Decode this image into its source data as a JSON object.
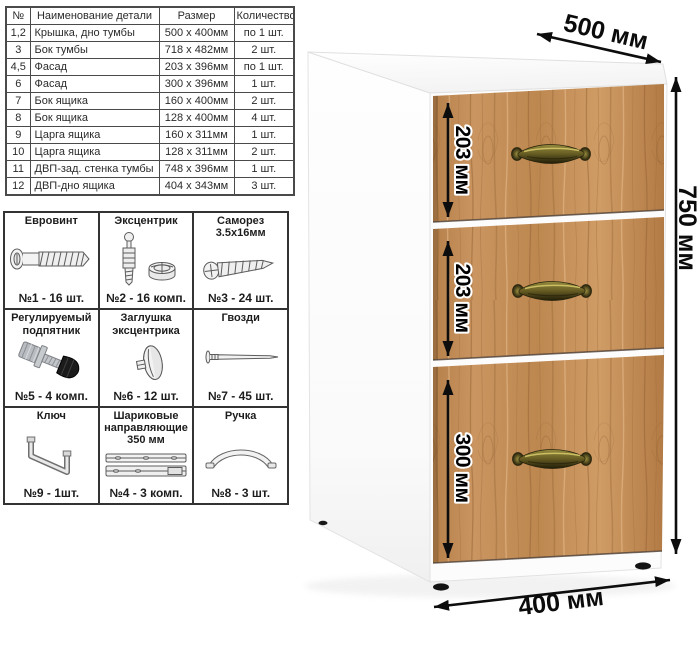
{
  "parts_table": {
    "headers": [
      "№",
      "Наименование детали",
      "Размер",
      "Количество"
    ],
    "rows": [
      {
        "num": "1,2",
        "name": "Крышка, дно тумбы",
        "size": "500 х 400мм",
        "qty": "по 1 шт."
      },
      {
        "num": "3",
        "name": "Бок тумбы",
        "size": "718 х 482мм",
        "qty": "2 шт."
      },
      {
        "num": "4,5",
        "name": "Фасад",
        "size": "203 х 396мм",
        "qty": "по 1 шт."
      },
      {
        "num": "6",
        "name": "Фасад",
        "size": "300 х 396мм",
        "qty": "1 шт."
      },
      {
        "num": "7",
        "name": "Бок ящика",
        "size": "160 х 400мм",
        "qty": "2 шт."
      },
      {
        "num": "8",
        "name": "Бок ящика",
        "size": "128 х 400мм",
        "qty": "4 шт."
      },
      {
        "num": "9",
        "name": "Царга ящика",
        "size": "160 х 311мм",
        "qty": "1 шт."
      },
      {
        "num": "10",
        "name": "Царга ящика",
        "size": "128 х 311мм",
        "qty": "2 шт."
      },
      {
        "num": "11",
        "name": "ДВП-зад. стенка тумбы",
        "size": "748 х 396мм",
        "qty": "1 шт."
      },
      {
        "num": "12",
        "name": "ДВП-дно ящика",
        "size": "404 х 343мм",
        "qty": "3 шт."
      }
    ]
  },
  "hardware": {
    "items": [
      {
        "title": "Евровинт",
        "count": "№1 - 16 шт.",
        "icon": "euro-screw"
      },
      {
        "title": "Эксцентрик",
        "count": "№2 - 16 комп.",
        "icon": "eccentric-cam"
      },
      {
        "title": "Саморез 3.5х16мм",
        "count": "№3 - 24 шт.",
        "icon": "self-tapping-screw"
      },
      {
        "title": "Регулируемый подпятник",
        "count": "№5 - 4 комп.",
        "icon": "adjustable-foot"
      },
      {
        "title": "Заглушка эксцентрика",
        "count": "№6 - 12 шт.",
        "icon": "cam-cap"
      },
      {
        "title": "Гвозди",
        "count": "№7 - 45 шт.",
        "icon": "nail"
      },
      {
        "title": "Ключ",
        "count": "№9 - 1шт.",
        "icon": "hex-key"
      },
      {
        "title": "Шариковые направляющие 350 мм",
        "count": "№4 - 3 комп.",
        "icon": "ball-slides"
      },
      {
        "title": "Ручка",
        "count": "№8 - 3 шт.",
        "icon": "handle"
      }
    ]
  },
  "cabinet": {
    "dim_depth": "500 мм",
    "dim_height": "750 мм",
    "dim_width": "400 мм",
    "drawer_dims": [
      "203 мм",
      "203 мм",
      "300 мм"
    ],
    "drawer_count": 3,
    "colors": {
      "wood": "#c18b55",
      "wood_dark": "#8f5e2f",
      "handle_bronze": "#6b6125",
      "body_white": "#fdfdfd",
      "dimension_text": "#0b0b0b"
    }
  }
}
